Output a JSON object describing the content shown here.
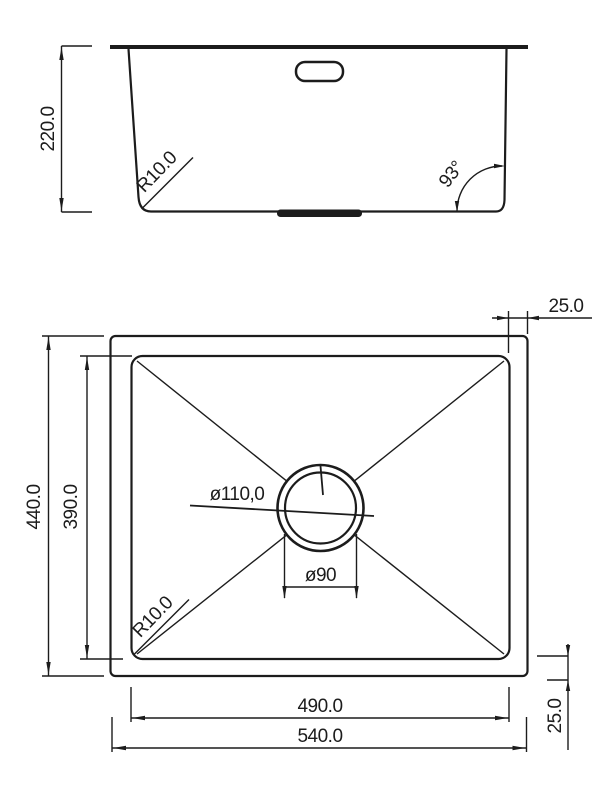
{
  "drawing": {
    "kind": "sink-technical-drawing",
    "colors": {
      "line": "#1c1c1c",
      "background": "#ffffff"
    },
    "side_view": {
      "height": "220.0",
      "corner_radius": "R10.0",
      "wall_angle": "93°"
    },
    "plan_view": {
      "overall_width": "540.0",
      "bowl_width": "490.0",
      "overall_depth": "440.0",
      "bowl_depth": "390.0",
      "rim_offset_top": "25.0",
      "rim_offset_bottom": "25.0",
      "drain_outer_diameter": "ø110,0",
      "drain_cutout_diameter": "ø90",
      "corner_radius": "R10.0"
    }
  }
}
